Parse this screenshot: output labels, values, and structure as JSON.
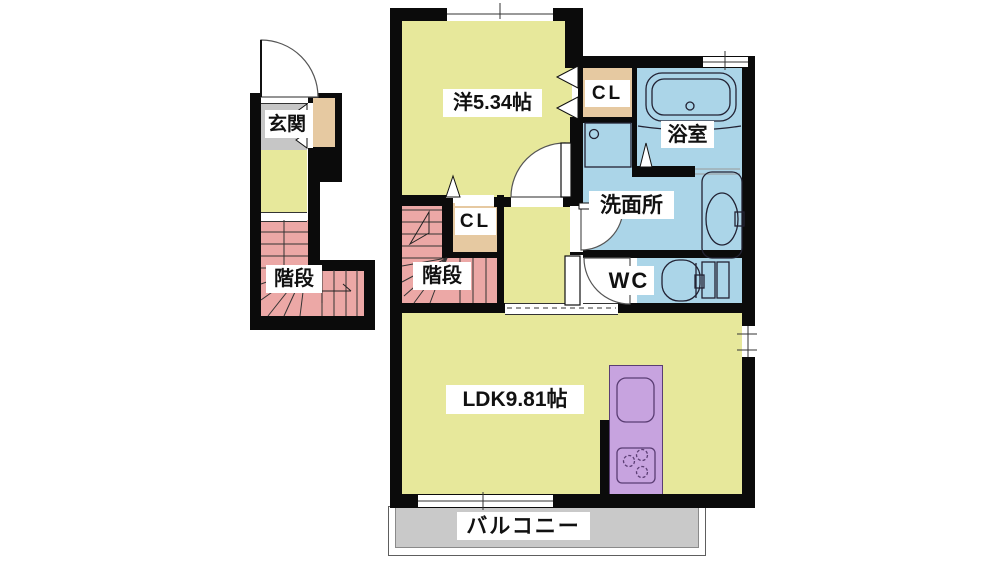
{
  "rooms": {
    "entrance": {
      "label": "玄関"
    },
    "stairs_left": {
      "label": "階段"
    },
    "stairs_main": {
      "label": "階段"
    },
    "western_room": {
      "label": "洋5.34帖"
    },
    "closet_hall": {
      "label": "CL"
    },
    "closet_bath": {
      "label": "CL"
    },
    "bathroom": {
      "label": "浴室"
    },
    "washroom": {
      "label": "洗面所"
    },
    "wc": {
      "label": "WC"
    },
    "ldk": {
      "label": "LDK9.81帖"
    },
    "balcony": {
      "label": "バルコニー"
    }
  },
  "colors": {
    "room_yellow": "#e7e89b",
    "stairs_pink": "#eca8a6",
    "water_blue": "#abd5e8",
    "kitchen_purple": "#c7a3df",
    "closet_tan": "#e6c9a1",
    "entrance_gray": "#c6c6c6",
    "balcony_gray": "#c9c9c9",
    "wall_black": "#0b0b0b"
  }
}
